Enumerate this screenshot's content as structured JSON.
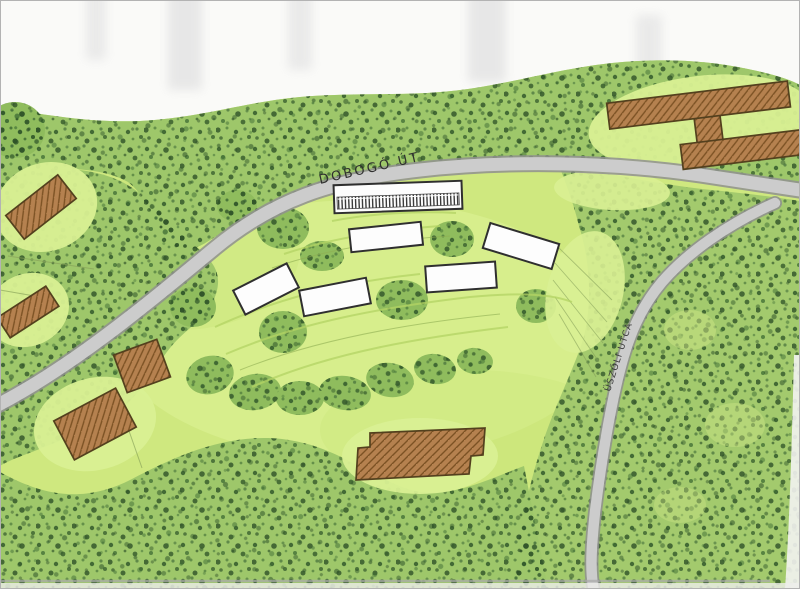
{
  "title": "Hand-drawn landscape site plan sketch",
  "roads": {
    "main": {
      "label": "DOBOGÓ ÚT"
    },
    "side": {
      "label": "ÜSZŐLI UTCA"
    }
  },
  "map": {
    "existing_buildings_count": 6,
    "proposed_buildings_count": 6,
    "features": [
      "forest",
      "meadow",
      "roads",
      "existing buildings (brown hatched)",
      "proposed buildings (white outlined)"
    ]
  },
  "palette": {
    "paper": "#fafaf8",
    "meadow": "#cfe87f",
    "meadow_light": "#d9f093",
    "forest_base": "#9ec76a",
    "forest_dots": "#33592b",
    "road_fill": "#cccccc",
    "road_edge": "#8f8f8f",
    "existing_building": "#b5814f",
    "building_hatch": "#7c5224",
    "building_outline": "#53401e",
    "proposed_building": "#fdfdfd",
    "outline": "#2f2f2f"
  }
}
